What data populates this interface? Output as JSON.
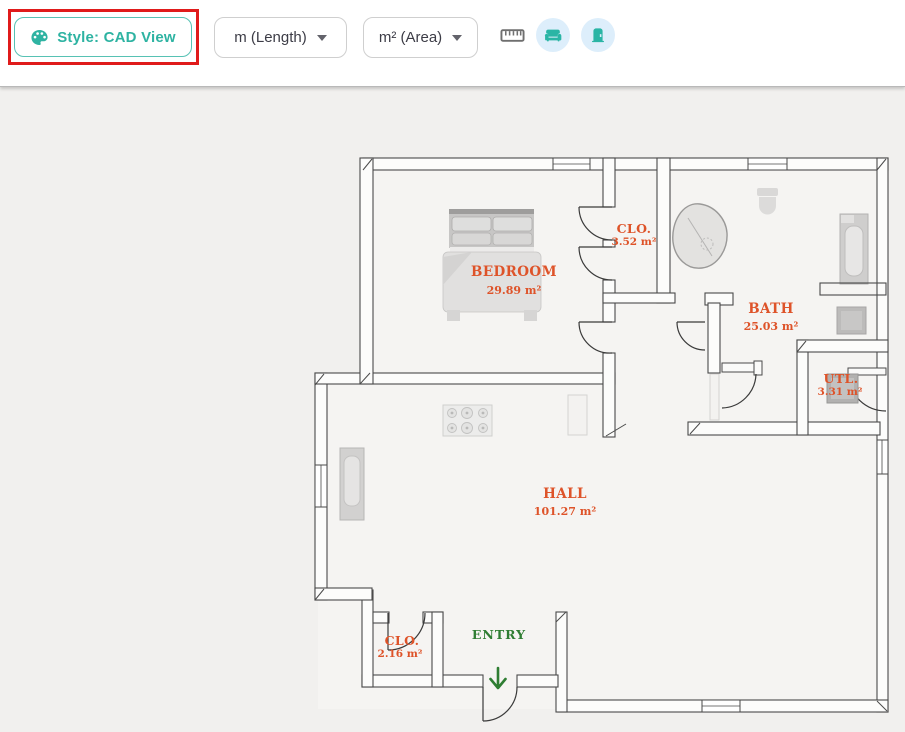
{
  "toolbar": {
    "style_button": {
      "label": "Style: CAD View",
      "icon": "palette-icon"
    },
    "length_dropdown": {
      "value": "m (Length)"
    },
    "area_dropdown": {
      "value": "m² (Area)"
    },
    "icons": {
      "ruler": "ruler-icon",
      "furniture": "sofa-icon",
      "door": "door-icon"
    },
    "colors": {
      "accent_teal": "#2eb3a2",
      "highlight_red": "#e01b1b",
      "icon_circle_bg": "#ddeefb"
    }
  },
  "floorplan": {
    "rooms": [
      {
        "name": "BEDROOM",
        "area": "29.89 m²"
      },
      {
        "name": "CLO.",
        "area": "3.52 m²"
      },
      {
        "name": "BATH",
        "area": "25.03 m²"
      },
      {
        "name": "UTL.",
        "area": "3.31 m²"
      },
      {
        "name": "HALL",
        "area": "101.27 m²"
      },
      {
        "name": "CLO.",
        "area": "2.16 m²"
      },
      {
        "name": "ENTRY",
        "area": ""
      }
    ],
    "colors": {
      "room_label": "#de5329",
      "entry_label": "#2e7d32",
      "wall": "#4a4a4a"
    }
  }
}
